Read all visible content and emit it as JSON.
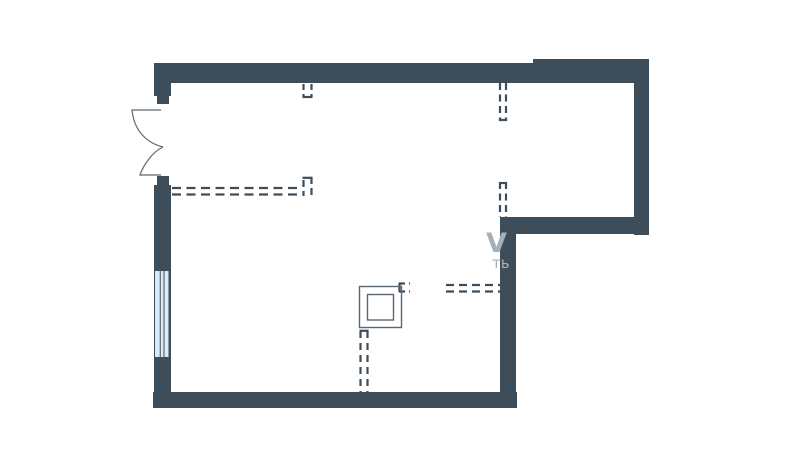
{
  "colors": {
    "background": "#ffffff",
    "wall": "#3d4e5a",
    "outline": "#5a6873",
    "window_fill": "#d9ebf7",
    "window_frame": "#3d4e5a",
    "watermark": "#a6b0b8"
  },
  "floorplan": {
    "watermark": {
      "mark": "V",
      "text": "ть"
    }
  }
}
